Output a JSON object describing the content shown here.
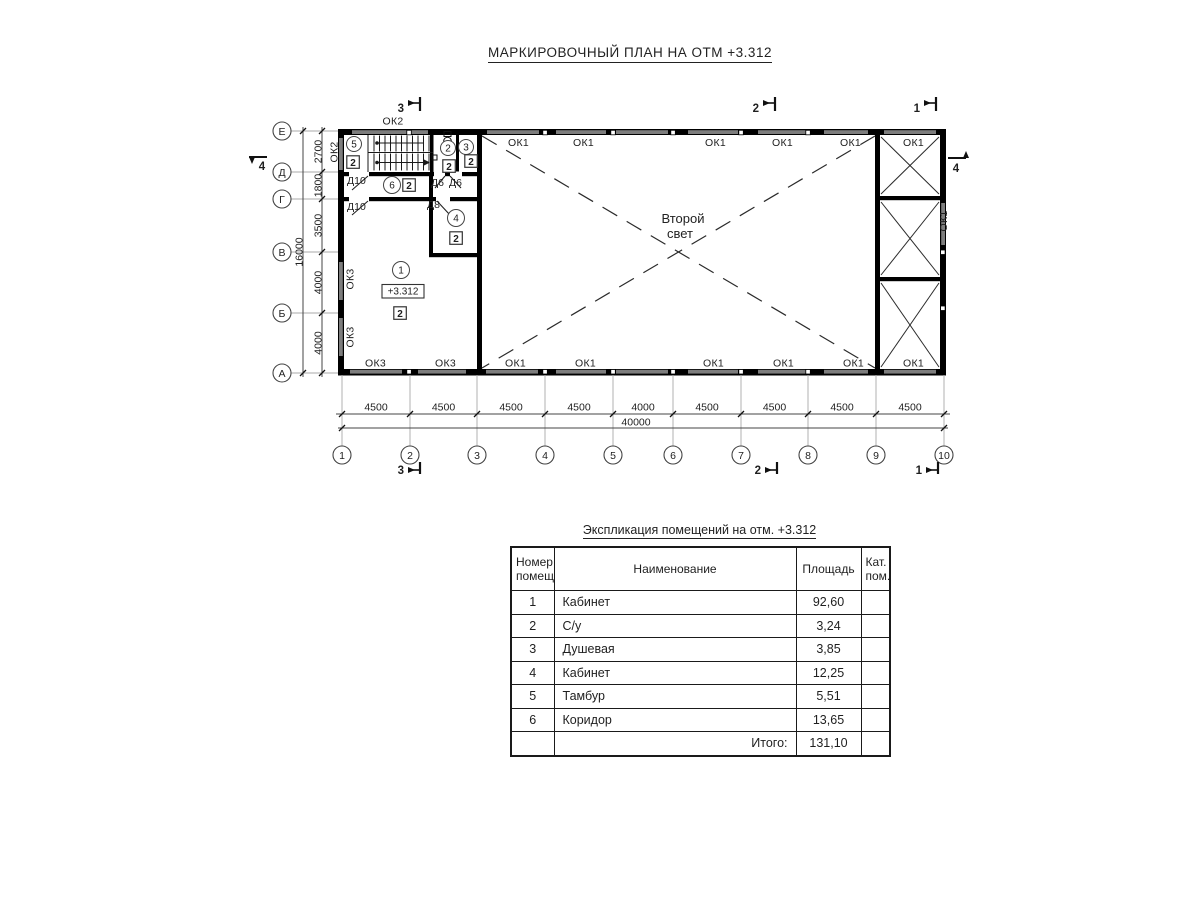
{
  "title": "МАРКИРОВОЧНЫЙ ПЛАН НА ОТМ +3.312",
  "plan": {
    "labels": {
      "ok1": "ОК1",
      "ok2": "ОК2",
      "ok3": "ОК3",
      "d10": "Д10",
      "d6": "Д6",
      "d8": "Д8"
    },
    "second_light": {
      "line1": "Второй",
      "line2": "свет"
    },
    "elevation": "+3.312",
    "category": "2",
    "rooms": {
      "r1": "1",
      "r2": "2",
      "r3": "3",
      "r4": "4",
      "r5": "5",
      "r6": "6"
    },
    "axes": {
      "cols": [
        "1",
        "2",
        "3",
        "4",
        "5",
        "6",
        "7",
        "8",
        "9",
        "10"
      ],
      "rows": [
        "Е",
        "Д",
        "Г",
        "В",
        "Б",
        "А"
      ]
    },
    "dims": {
      "bottom": [
        "4500",
        "4500",
        "4500",
        "4500",
        "4000",
        "4500",
        "4500",
        "4500",
        "4500"
      ],
      "bottom_total": "40000",
      "left": [
        "2700",
        "1800",
        "3500",
        "4000",
        "4000"
      ],
      "left_total": "16000"
    },
    "sections": {
      "s1": "1",
      "s2": "2",
      "s3": "3",
      "s4": "4"
    }
  },
  "table": {
    "title": "Экспликация помещений на отм. +3.312",
    "headers": {
      "num": "Номер\nпомещ.",
      "name": "Наименование",
      "area": "Площадь",
      "cat": "Кат.\nпом."
    },
    "rows": [
      {
        "num": "1",
        "name": "Кабинет",
        "area": "92,60",
        "cat": ""
      },
      {
        "num": "2",
        "name": "С/у",
        "area": "3,24",
        "cat": ""
      },
      {
        "num": "3",
        "name": "Душевая",
        "area": "3,85",
        "cat": ""
      },
      {
        "num": "4",
        "name": "Кабинет",
        "area": "12,25",
        "cat": ""
      },
      {
        "num": "5",
        "name": "Тамбур",
        "area": "5,51",
        "cat": ""
      },
      {
        "num": "6",
        "name": "Коридор",
        "area": "13,65",
        "cat": ""
      }
    ],
    "total": {
      "label": "Итого:",
      "area": "131,10",
      "cat": ""
    }
  }
}
